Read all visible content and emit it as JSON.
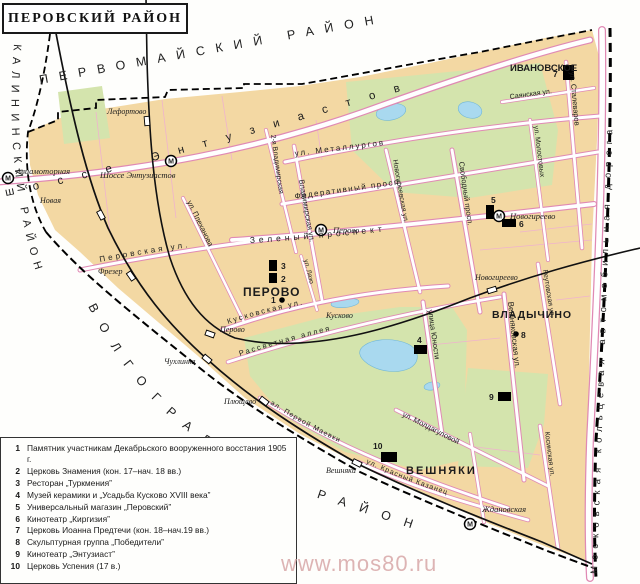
{
  "title": "ПЕРОВСКИЙ РАЙОН",
  "watermark": "www.mos80.ru",
  "icons": {
    "metro_letter": "М"
  },
  "colors": {
    "block": "#f3d8a3",
    "park": "#d4e4ad",
    "water": "#a9d9ef",
    "road_edge": "#e08ab4",
    "railway": "#000000",
    "boundary": "#000000",
    "watermark": "#d8a8a8"
  },
  "districts": {
    "top": "ПЕРВОМАЙСКИЙ РАЙОН",
    "left": "КАЛИНИНСКИЙ РАЙОН",
    "bottom_left": "ВОЛГОГРАДСКИЙ РАЙОН",
    "right_road": "Московская кольцевая автомобильная дорога"
  },
  "neighborhoods": {
    "perovo": "ПЕРОВО",
    "ivanovskoe": "ИВАНОВСКОЕ",
    "vladychino": "ВЛАДЫЧИНО",
    "veshnyaki": "ВЕШНЯКИ"
  },
  "metro": {
    "aviamotornaya": "Авиамоторная",
    "shosse_entuziastov": "Шоссе Энтузиастов",
    "perovo": "Перово",
    "novogireevo": "Новогиреево",
    "zhdanovskaya": "Ждановская"
  },
  "rail_stations": {
    "lefortovo": "Лефортово",
    "novaya": "Новая",
    "frezer": "Фрезер",
    "perovo": "Перово",
    "chukhlinka": "Чухлинка",
    "plyushchevo": "Плющево",
    "veshnyaki": "Вешняки",
    "novogireevo": "Новогиреево",
    "kuskovo": "Кусково"
  },
  "streets": {
    "shosse_entuziastov": "шоссе Энтузиастов",
    "metallurgov": "ул. Металлургов",
    "federativny": "Федеративный просп.",
    "zeleny": "Зеленый проспект",
    "perovskaya": "Перовская ул.",
    "kuskovskaya": "Кусковская ул.",
    "rassvetnaya": "Рассветная аллея",
    "pervoy_mayevki": "ал. Первой Маевки",
    "svobodny": "Свободный просп.",
    "novogireevskaya": "Новогиреевская ул.",
    "vladimirskaya": "Владимирская ул.",
    "vladimirskaya_2": "2-я Владимирская",
    "plekhanova": "ул. Плеханова",
    "lazo": "ул. Лазо",
    "stalevarov": "ул. Сталеваров",
    "molostovykh": "ул. Молостовых",
    "sayanskaya": "Саянская ул.",
    "yunosti": "улица Юности",
    "veshnyakovskaya": "Вешняковская ул.",
    "reutovskaya": "Реутовская ул.",
    "moldagulovoy": "ул. Молдагуловой",
    "krasny_kazanets": "ул. Красный Казанец",
    "kosinskaya": "Косинская ул."
  },
  "markers": {
    "m1": "1",
    "m2": "2",
    "m3": "3",
    "m4": "4",
    "m5": "5",
    "m6": "6",
    "m7": "7",
    "m8": "8",
    "m9": "9",
    "m10": "10"
  },
  "legend": {
    "items": [
      {
        "num": "1",
        "text": "Памятник участникам Декабрьского вооруженного восстания 1905 г."
      },
      {
        "num": "2",
        "text": "Церковь Знамения (кон. 17–нач. 18 вв.)"
      },
      {
        "num": "3",
        "text": "Ресторан „Туркмения”"
      },
      {
        "num": "4",
        "text": "Музей керамики и „Усадьба Кусково XVIII века”"
      },
      {
        "num": "5",
        "text": "Универсальный магазин „Перовский”"
      },
      {
        "num": "6",
        "text": "Кинотеатр „Киргизия”"
      },
      {
        "num": "7",
        "text": "Церковь Иоанна Предтечи (кон. 18–нач.19 вв.)"
      },
      {
        "num": "8",
        "text": "Скульптурная группа „Победители”"
      },
      {
        "num": "9",
        "text": "Кинотеатр „Энтузиаст”"
      },
      {
        "num": "10",
        "text": "Церковь Успения (17 в.)"
      }
    ]
  }
}
